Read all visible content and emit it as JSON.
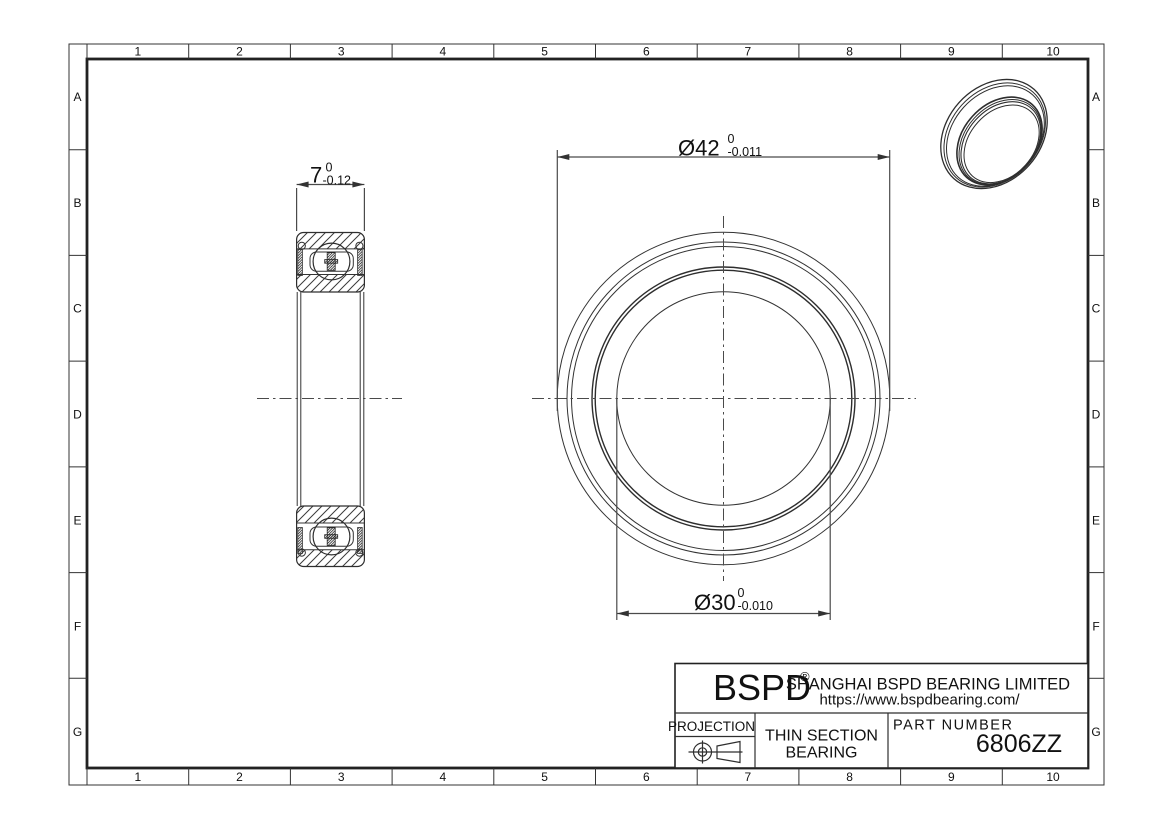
{
  "grid": {
    "columns": [
      "1",
      "2",
      "3",
      "4",
      "5",
      "6",
      "7",
      "8",
      "9",
      "10"
    ],
    "rows": [
      "A",
      "B",
      "C",
      "D",
      "E",
      "F",
      "G"
    ]
  },
  "dims": {
    "od": {
      "value": "Ø42",
      "tol_upper": "0",
      "tol_lower": "-0.011"
    },
    "bore": {
      "value": "Ø30",
      "tol_upper": "0",
      "tol_lower": "-0.010"
    },
    "width": {
      "value": "7",
      "tol_upper": "0",
      "tol_lower": "-0.12"
    }
  },
  "title_block": {
    "logo": "BSPD",
    "logo_reg": "®",
    "company": "SHANGHAI BSPD BEARING LIMITED",
    "website": "https://www.bspdbearing.com/",
    "projection_label": "PROJECTION",
    "product_line1": "THIN SECTION",
    "product_line2": "BEARING",
    "part_number_label": "PART NUMBER",
    "part_number": "6806ZZ"
  },
  "colors": {
    "line": "#333333",
    "text": "#111111",
    "background": "#ffffff"
  }
}
